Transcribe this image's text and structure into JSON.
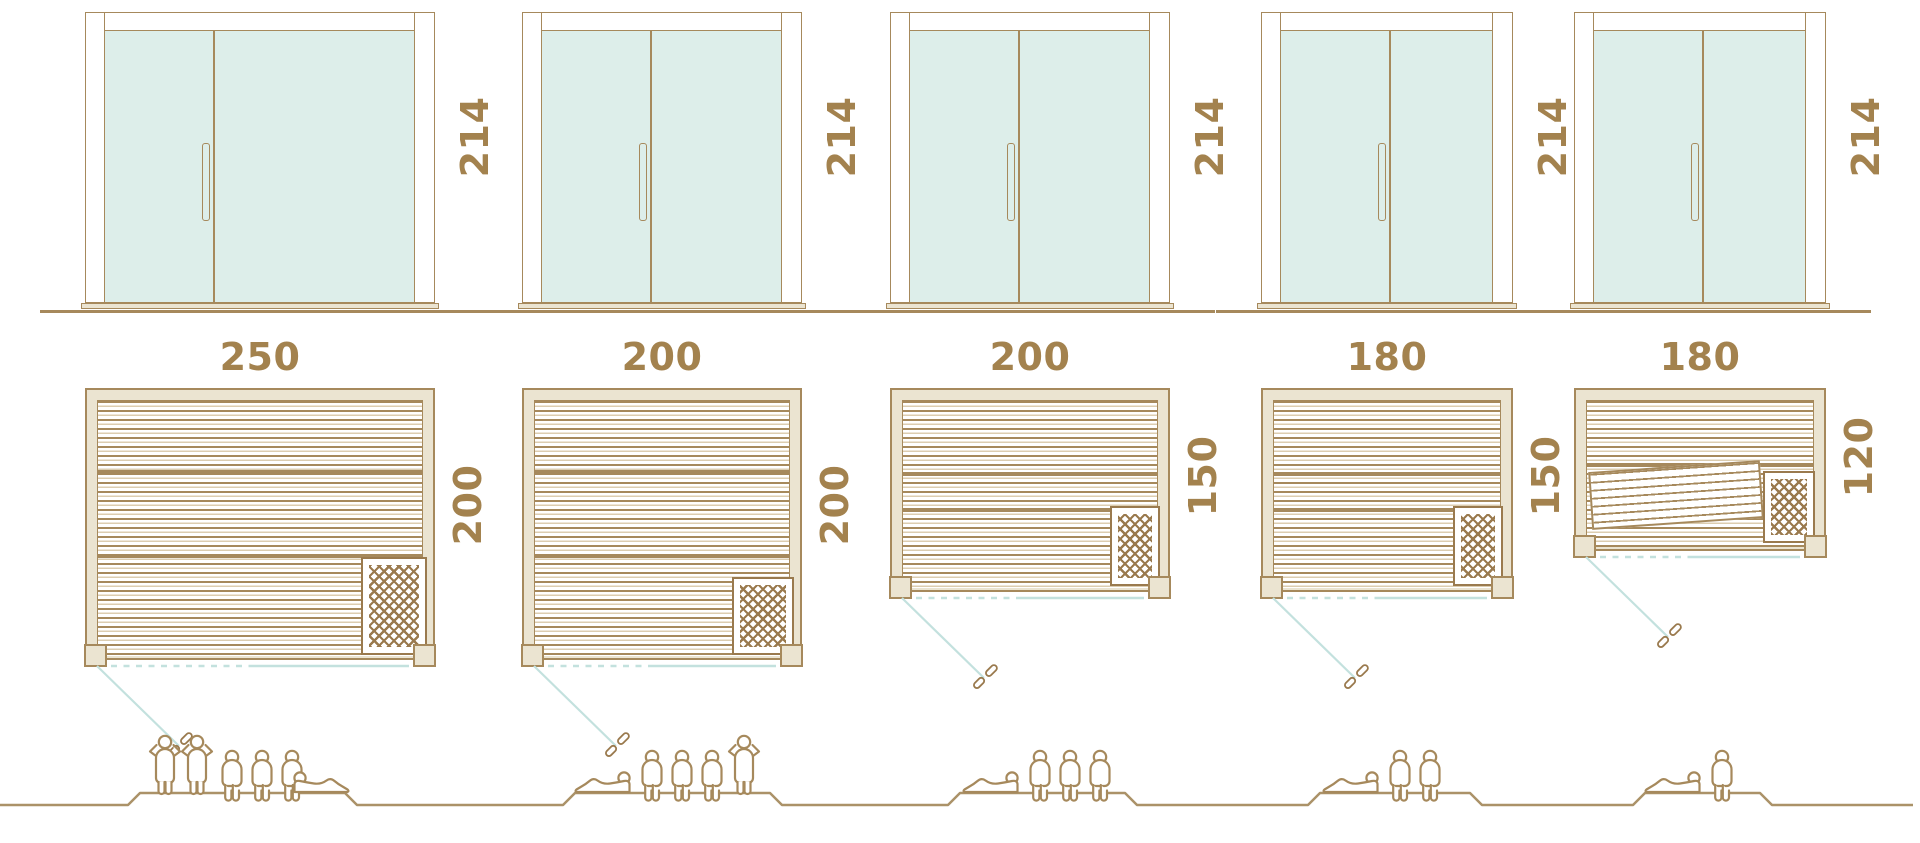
{
  "palette": {
    "line": "#a6895c",
    "text": "#a3824e",
    "hatch": "#9a7a4e",
    "cream": "#ebe4d1",
    "glass": "#ddeeea",
    "teal": "#c3e1de",
    "slatlight": "#dccdb0",
    "ground": "#ab9268"
  },
  "models": [
    {
      "door_height": "214",
      "width": "250",
      "depth": "200",
      "capacity": {
        "standing": 2,
        "seated": 3,
        "lying": 1,
        "total": 6
      }
    },
    {
      "door_height": "214",
      "width": "200",
      "depth": "200",
      "capacity": {
        "standing": 1,
        "seated": 3,
        "lying": 1,
        "total": 5
      }
    },
    {
      "door_height": "214",
      "width": "200",
      "depth": "150",
      "capacity": {
        "standing": 0,
        "seated": 3,
        "lying": 1,
        "total": 4
      }
    },
    {
      "door_height": "214",
      "width": "180",
      "depth": "150",
      "capacity": {
        "standing": 0,
        "seated": 2,
        "lying": 1,
        "total": 3
      }
    },
    {
      "door_height": "214",
      "width": "180",
      "depth": "120",
      "capacity": {
        "standing": 0,
        "seated": 1,
        "lying": 1,
        "total": 2
      }
    }
  ]
}
